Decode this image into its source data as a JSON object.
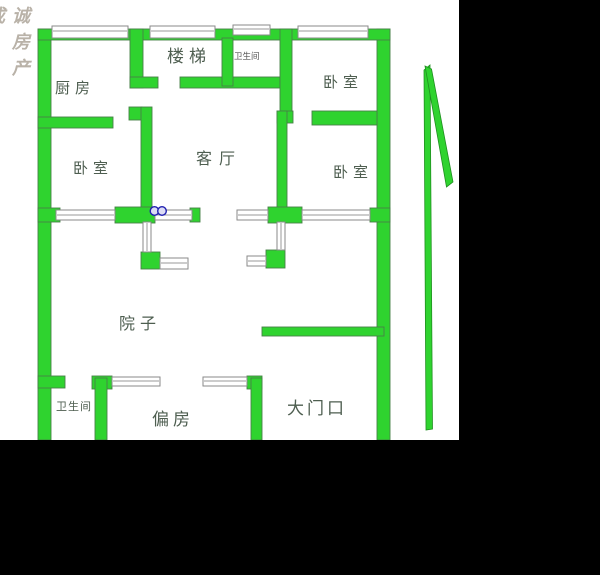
{
  "watermark": {
    "partial": "成",
    "text": "诚 房 产"
  },
  "rooms": {
    "kitchen": "厨房",
    "stairs": "楼梯",
    "bath_small": "卫生间",
    "bedroom_top_right": "卧室",
    "bedroom_mid_left": "卧室",
    "living_room": "客厅",
    "bedroom_mid_right": "卧室",
    "yard": "院子",
    "bath_bottom": "卫生间",
    "side_room": "偏房",
    "main_entrance": "大门口"
  },
  "colors": {
    "wall_green": "#2fd32f",
    "wall_outline": "#478047",
    "window_frame_gray": "#8a8a8a",
    "fixture_blue": "#2020b0",
    "label_gray_green": "#4e5e50",
    "watermark_gray": "#b9b2a8",
    "background_black": "#000000",
    "plan_background": "#ffffff"
  }
}
